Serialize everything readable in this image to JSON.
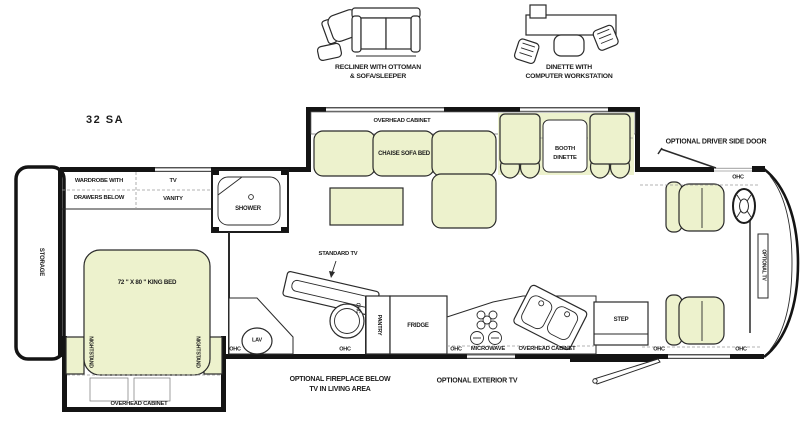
{
  "model": {
    "name": "32 SA"
  },
  "legend": {
    "recliner_option": {
      "line1": "RECLINER WITH OTTOMAN",
      "line2": "& SOFA/SLEEPER"
    },
    "dinette_option": {
      "line1": "DINETTE WITH",
      "line2": "COMPUTER WORKSTATION"
    }
  },
  "bedroom": {
    "storage": "STORAGE",
    "wardrobe_line1": "WARDROBE WITH",
    "wardrobe_line2": "DRAWERS BELOW",
    "tv": "TV",
    "vanity": "VANITY",
    "king_bed": "72 \" X 80 \" KING BED",
    "nightstand_left": "NIGHTSTAND",
    "nightstand_right": "NIGHTSTAND",
    "overhead_cabinet": "OVERHEAD CABINET"
  },
  "bathroom": {
    "shower": "SHOWER",
    "lav": "LAV",
    "ohc_lav": "OHC",
    "ohc_toilet_side": "OHC",
    "ohc_toilet_bottom": "OHC"
  },
  "living": {
    "overhead_cabinet": "OVERHEAD CABINET",
    "chaise_sofa_bed": "CHAISE SOFA BED",
    "booth_line1": "BOOTH",
    "booth_line2": "DINETTE",
    "standard_tv": "STANDARD TV",
    "fireplace_line1": "OPTIONAL FIREPLACE BELOW",
    "fireplace_line2": "TV IN LIVING AREA"
  },
  "kitchen": {
    "pantry": "PANTRY",
    "fridge": "FRIDGE",
    "ohc": "OHC",
    "microwave": "MICROWAVE",
    "overhead_cabinet": "OVERHEAD CABINET",
    "exterior_tv": "OPTIONAL EXTERIOR TV",
    "step": "STEP"
  },
  "cockpit": {
    "driver_door": "OPTIONAL DRIVER SIDE DOOR",
    "ohc_top": "OHC",
    "ohc_bottom_left": "OHC",
    "ohc_bottom_right": "OHC",
    "optional_tv": "OPTIONAL TV"
  },
  "colors": {
    "furniture_fill": "#edf2cd",
    "line": "#2a2a2a",
    "wall": "#141414",
    "dash": "#9a9a9a"
  }
}
